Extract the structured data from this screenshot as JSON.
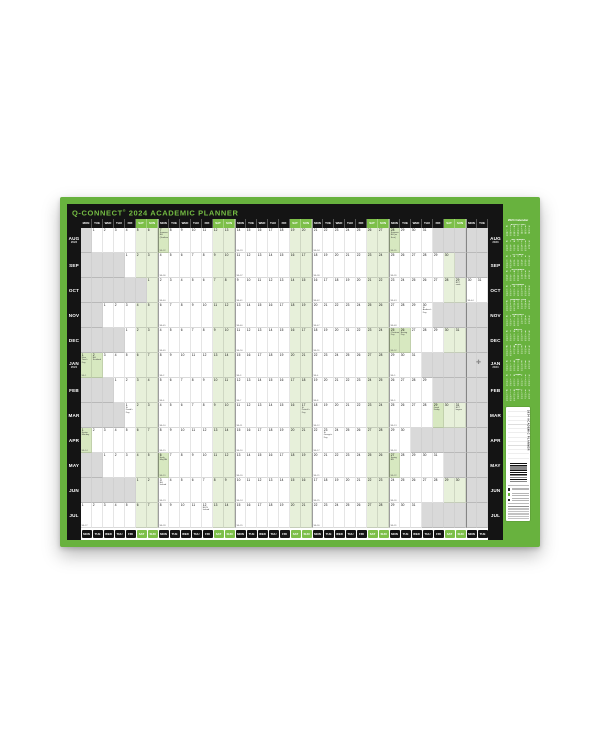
{
  "product": {
    "brand": "Q-CONNECT",
    "registered_mark": "®",
    "title": "2024 ACADEMIC PLANNER"
  },
  "colors": {
    "frame_green": "#68b23e",
    "weekend_green": "#7dbf49",
    "weekend_tint": "#e7f0da",
    "holiday_tint": "#d7e8c0",
    "out_of_month_grey": "#d9d9d9",
    "bar_black": "#141414",
    "title_text_green": "#74bc43"
  },
  "calendar": {
    "day_names": [
      "MON",
      "TUE",
      "WED",
      "THU",
      "FRI",
      "SAT",
      "SUN"
    ],
    "total_columns": 37,
    "months": [
      {
        "label": "AUG",
        "year": "2023",
        "start_col": 2,
        "days": 31,
        "holidays": {
          "7": "Summer BH (Scotland)",
          "28": "Summer BH (ex Scot)"
        },
        "tinted": [
          7,
          28
        ],
        "weeks": {
          "7": "Wk 32",
          "14": "Wk 33",
          "21": "Wk 34",
          "28": "Wk 35"
        }
      },
      {
        "label": "SEP",
        "year": "",
        "start_col": 5,
        "days": 30,
        "holidays": {},
        "tinted": [],
        "weeks": {
          "4": "Wk 36",
          "11": "Wk 37",
          "18": "Wk 38",
          "25": "Wk 39"
        }
      },
      {
        "label": "OCT",
        "year": "",
        "start_col": 7,
        "days": 31,
        "holidays": {
          "29": "BST ends"
        },
        "tinted": [],
        "weeks": {
          "2": "Wk 40",
          "9": "Wk 41",
          "16": "Wk 42",
          "23": "Wk 43",
          "30": "Wk 44"
        }
      },
      {
        "label": "NOV",
        "year": "",
        "start_col": 3,
        "days": 30,
        "holidays": {
          "30": "St Andrew's Day"
        },
        "tinted": [],
        "weeks": {
          "6": "Wk 45",
          "13": "Wk 46",
          "20": "Wk 47",
          "27": "Wk 48"
        }
      },
      {
        "label": "DEC",
        "year": "",
        "start_col": 5,
        "days": 31,
        "holidays": {
          "25": "Christmas Day",
          "26": "Boxing Day"
        },
        "tinted": [
          25,
          26
        ],
        "weeks": {
          "4": "Wk 49",
          "11": "Wk 50",
          "18": "Wk 51",
          "25": "Wk 52"
        }
      },
      {
        "label": "JAN",
        "year": "2024",
        "start_col": 1,
        "days": 31,
        "holidays": {
          "1": "New Year's Day",
          "2": "BH Scotland"
        },
        "tinted": [
          1,
          2
        ],
        "weeks": {
          "1": "Wk 1",
          "8": "Wk 2",
          "15": "Wk 3",
          "22": "Wk 4",
          "29": "Wk 5"
        }
      },
      {
        "label": "FEB",
        "year": "",
        "start_col": 4,
        "days": 29,
        "holidays": {},
        "tinted": [],
        "weeks": {
          "5": "Wk 6",
          "12": "Wk 7",
          "19": "Wk 8",
          "26": "Wk 9"
        }
      },
      {
        "label": "MAR",
        "year": "",
        "start_col": 5,
        "days": 31,
        "holidays": {
          "1": "St David's Day",
          "17": "St Patrick's Day",
          "29": "Good Friday",
          "31": "BST begins"
        },
        "tinted": [
          29
        ],
        "weeks": {
          "4": "Wk 10",
          "11": "Wk 11",
          "18": "Wk 12",
          "25": "Wk 13"
        }
      },
      {
        "label": "APR",
        "year": "",
        "start_col": 1,
        "days": 30,
        "holidays": {
          "1": "Easter Monday",
          "23": "St George's Day"
        },
        "tinted": [
          1
        ],
        "weeks": {
          "1": "Wk 14",
          "8": "Wk 15",
          "15": "Wk 16",
          "22": "Wk 17",
          "29": "Wk 18"
        }
      },
      {
        "label": "MAY",
        "year": "",
        "start_col": 3,
        "days": 31,
        "holidays": {
          "6": "Early May BH",
          "27": "Spring BH"
        },
        "tinted": [
          6,
          27
        ],
        "weeks": {
          "6": "Wk 19",
          "13": "Wk 20",
          "20": "Wk 21",
          "27": "Wk 22"
        }
      },
      {
        "label": "JUN",
        "year": "",
        "start_col": 6,
        "days": 30,
        "holidays": {
          "3": "BH Ireland"
        },
        "tinted": [],
        "weeks": {
          "3": "Wk 23",
          "10": "Wk 24",
          "17": "Wk 25",
          "24": "Wk 26"
        }
      },
      {
        "label": "JUL",
        "year": "",
        "start_col": 1,
        "days": 31,
        "holidays": {
          "12": "BH N Ireland"
        },
        "tinted": [],
        "weeks": {
          "1": "Wk 27",
          "8": "Wk 28",
          "15": "Wk 29",
          "22": "Wk 30",
          "29": "Wk 31"
        }
      }
    ]
  },
  "side_panel": {
    "heading": "2024 Calendar",
    "mini_day_initials": [
      "M",
      "T",
      "W",
      "T",
      "F",
      "S",
      "S"
    ],
    "mini_month_titles": [
      "AUGUST 2023",
      "SEPTEMBER",
      "OCTOBER",
      "NOVEMBER",
      "DECEMBER",
      "JANUARY 2024",
      "FEBRUARY",
      "MARCH",
      "APRIL",
      "MAY",
      "JUNE",
      "JULY"
    ]
  },
  "info_panel": {
    "vertical_text": "2024 ACADEMIC PLANNER"
  }
}
